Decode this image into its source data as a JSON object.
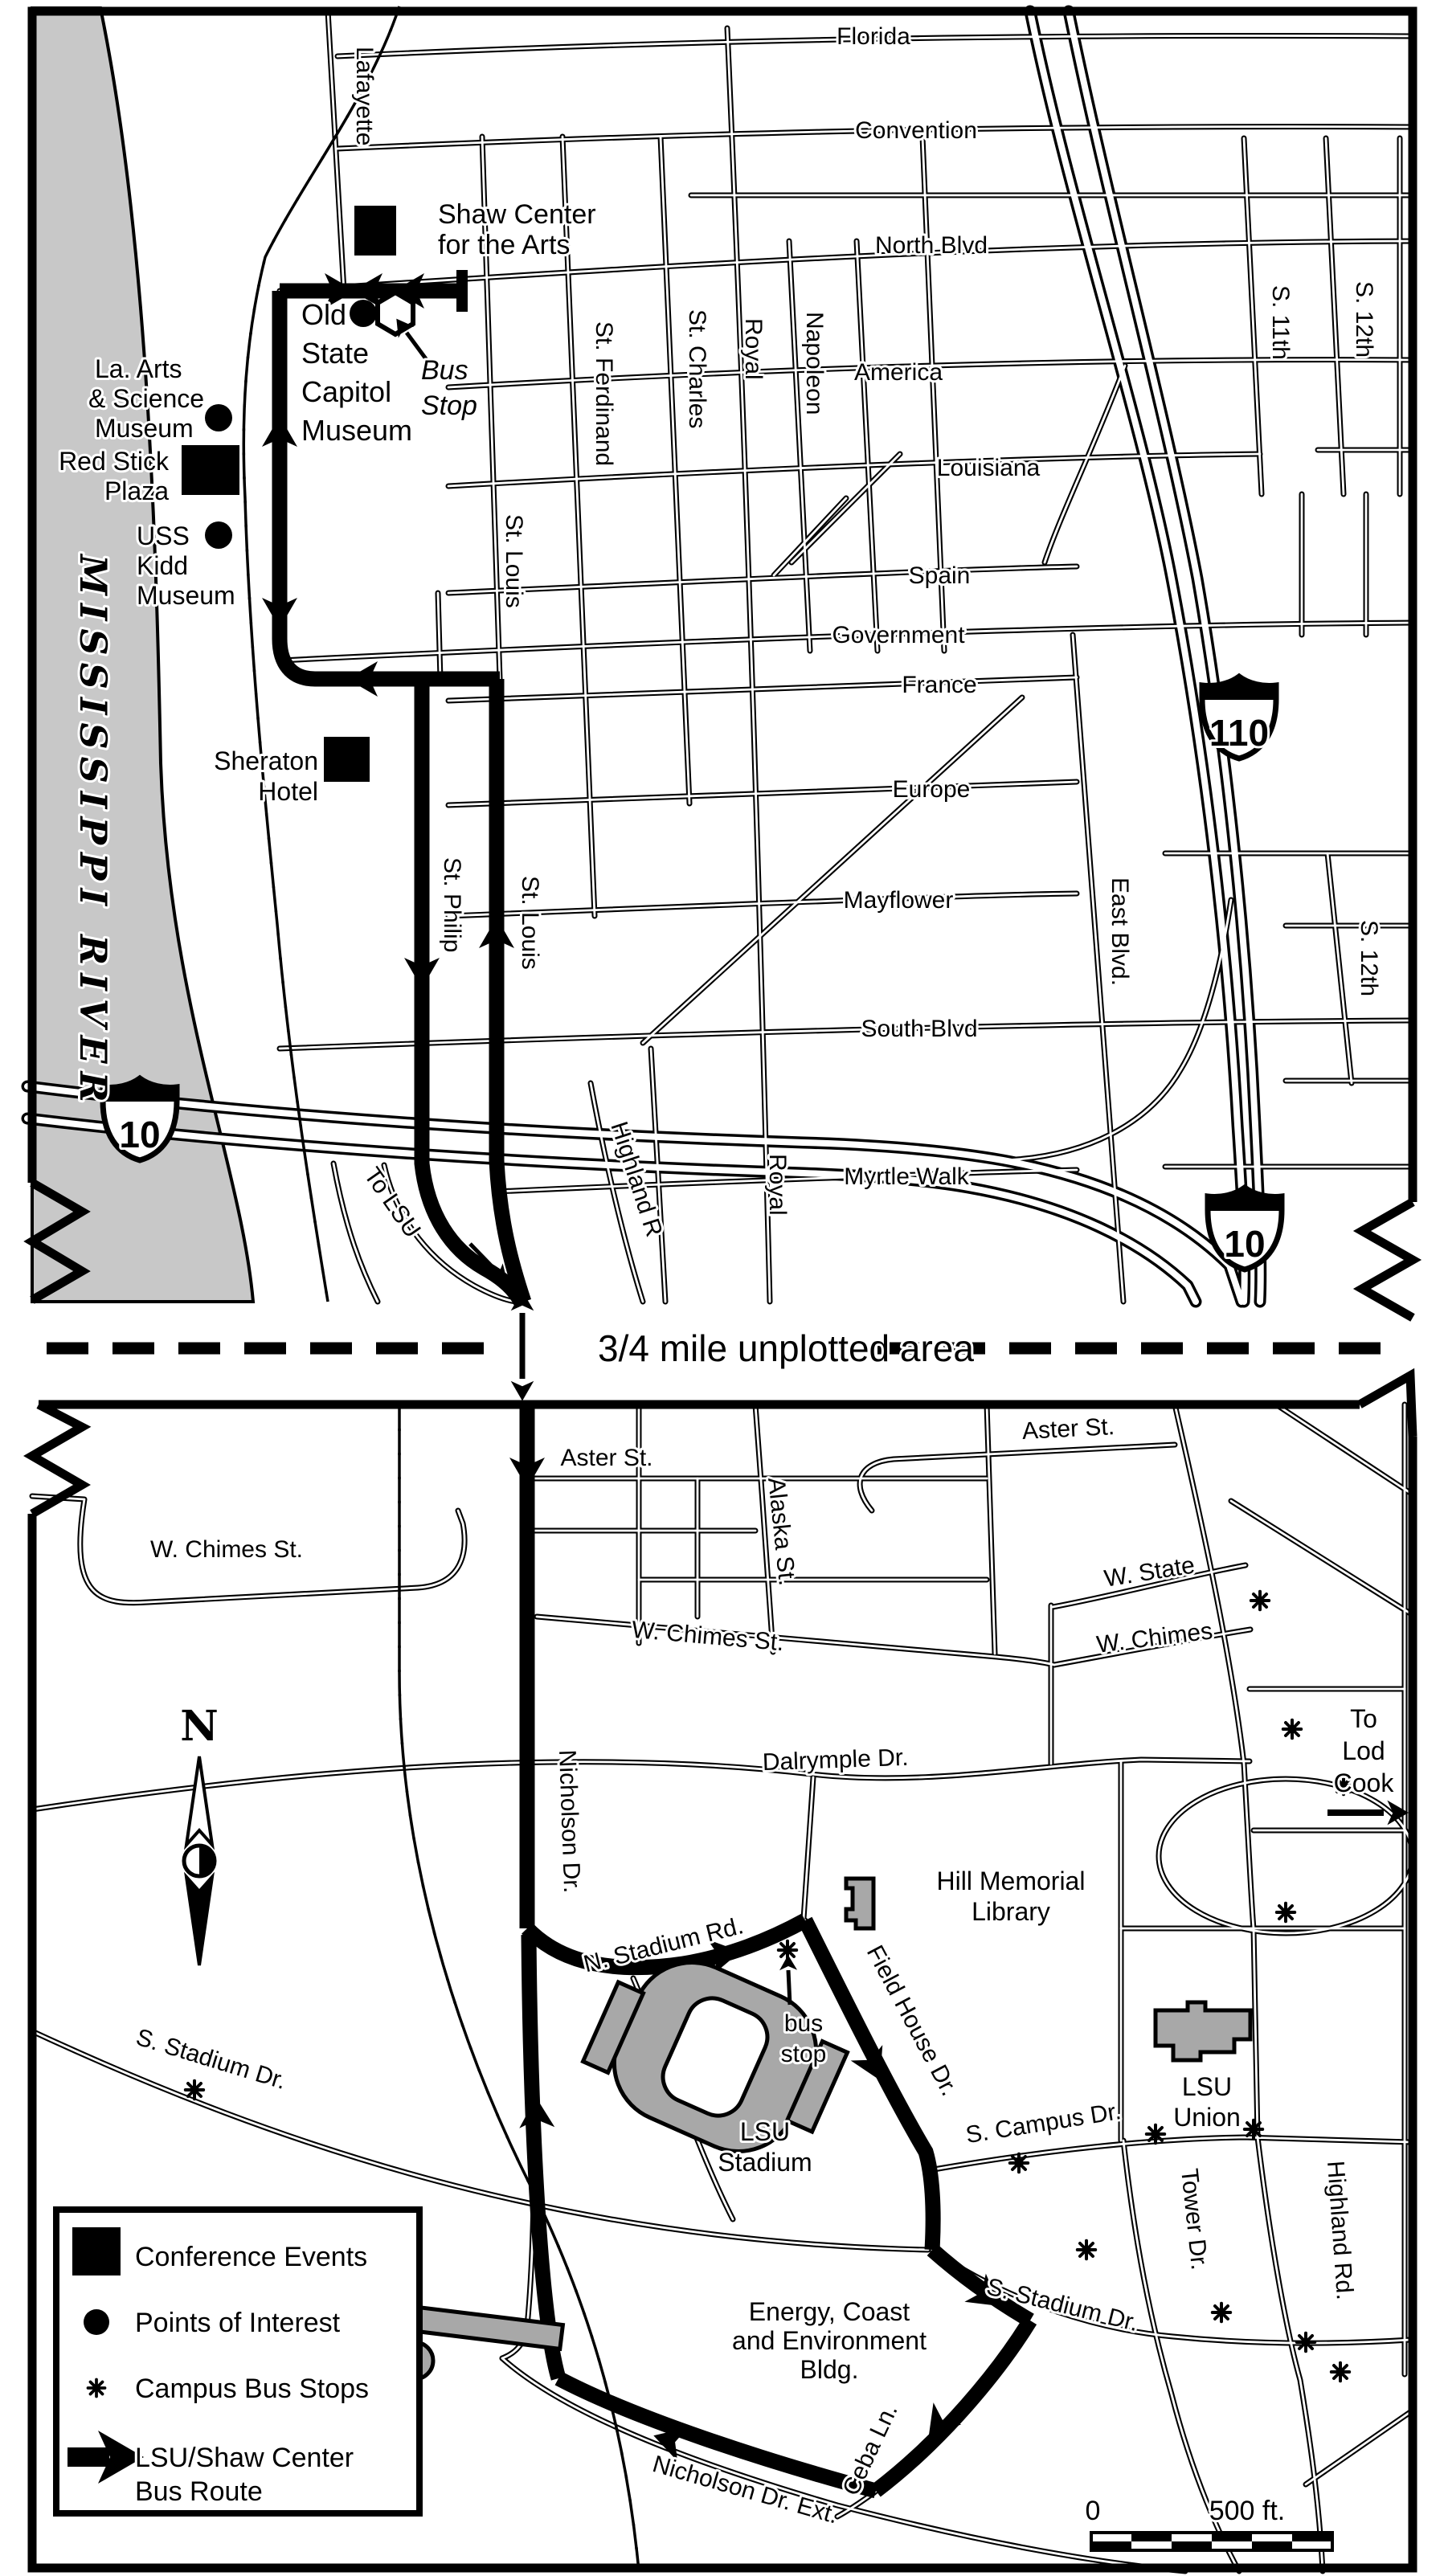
{
  "map": {
    "divider_label": "3/4 mile unplotted area",
    "compass_n": "N",
    "river_name": "MISSISSIPPI RIVER",
    "shield_i110": "110",
    "shield_i10": "10",
    "scale": {
      "zero": "0",
      "label": "500 ft."
    },
    "legend": {
      "conference": "Conference Events",
      "poi": "Points of Interest",
      "bus_stops": "Campus Bus Stops",
      "route_line1": "LSU/Shaw Center",
      "route_line2": "Bus Route"
    },
    "downtown": {
      "streets": {
        "florida": "Florida",
        "convention": "Convention",
        "north_blvd": "North Blvd",
        "america": "America",
        "louisiana": "Louisiana",
        "spain": "Spain",
        "government": "Government",
        "france": "France",
        "europe": "Europe",
        "mayflower": "Mayflower",
        "south_blvd": "South Blvd",
        "myrtle_walk": "Myrtle Walk",
        "lafayette": "Lafayette",
        "st_louis": "St. Louis",
        "st_ferdinand": "St. Ferdinand",
        "st_charles": "St. Charles",
        "royal": "Royal",
        "napoleon": "Napoleon",
        "east_blvd": "East Blvd.",
        "s_11th": "S. 11th",
        "s_12th": "S. 12th",
        "st_philip": "St. Philip",
        "highland_r": "Highland R",
        "to_lsu": "To LSU"
      },
      "landmarks": {
        "shaw_line1": "Shaw Center",
        "shaw_line2": "for the Arts",
        "capitol_line1": "Old",
        "capitol_line2": "State",
        "capitol_line3": "Capitol",
        "capitol_line4": "Museum",
        "bus_stop_line1": "Bus",
        "bus_stop_line2": "Stop",
        "arts_line1": "La. Arts",
        "arts_line2": "& Science",
        "arts_line3": "Museum",
        "redstick_line1": "Red Stick",
        "redstick_line2": "Plaza",
        "kidd_line1": "USS",
        "kidd_line2": "Kidd",
        "kidd_line3": "Museum",
        "sheraton_line1": "Sheraton",
        "sheraton_line2": "Hotel"
      }
    },
    "campus": {
      "streets": {
        "aster": "Aster St.",
        "w_chimes_st": "W. Chimes St.",
        "w_state": "W. State",
        "w_chimes": "W. Chimes",
        "alaska": "Alaska St.",
        "dalrymple": "Dalrymple Dr.",
        "nicholson": "Nicholson Dr.",
        "n_stadium": "N. Stadium Rd.",
        "field_house": "Field House Dr.",
        "s_campus": "S. Campus Dr.",
        "s_stadium": "S. Stadium Dr.",
        "tower": "Tower Dr.",
        "highland_rd": "Highland Rd.",
        "ceba": "Ceba Ln.",
        "nicholson_ext": "Nicholson Dr. Ext."
      },
      "landmarks": {
        "hill_line1": "Hill Memorial",
        "hill_line2": "Library",
        "stadium_line1": "LSU",
        "stadium_line2": "Stadium",
        "union_line1": "LSU",
        "union_line2": "Union",
        "energy_line1": "Energy, Coast",
        "energy_line2": "and Environment",
        "energy_line3": "Bldg.",
        "bus_stop_line1": "bus",
        "bus_stop_line2": "stop",
        "lod_line1": "To",
        "lod_line2": "Lod",
        "lod_line3": "Cook"
      }
    }
  }
}
